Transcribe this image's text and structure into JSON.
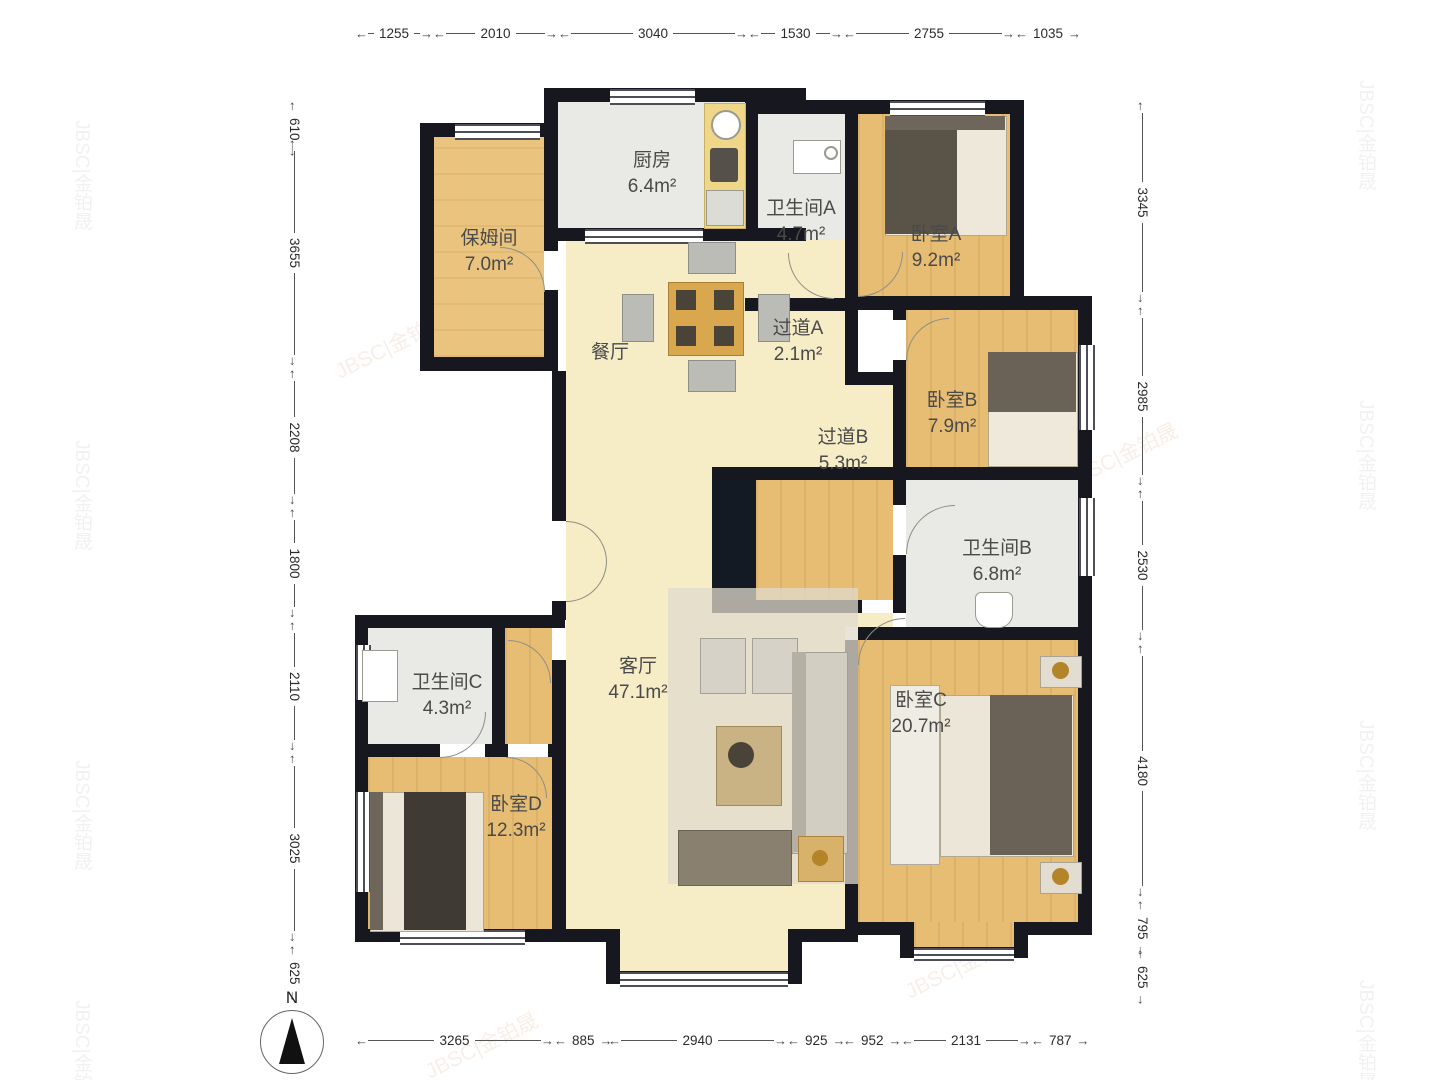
{
  "compass": {
    "label": "N"
  },
  "watermark": {
    "text": "JBSC|金铂晟"
  },
  "rooms": {
    "kitchen": {
      "name": "厨房",
      "area": "6.4m²"
    },
    "nanny": {
      "name": "保姆间",
      "area": "7.0m²"
    },
    "bathA": {
      "name": "卫生间A",
      "area": "4.7m²"
    },
    "bedA": {
      "name": "卧室A",
      "area": "9.2m²"
    },
    "hallA": {
      "name": "过道A",
      "area": "2.1m²"
    },
    "dining": {
      "name": "餐厅",
      "area": ""
    },
    "bedB": {
      "name": "卧室B",
      "area": "7.9m²"
    },
    "hallB": {
      "name": "过道B",
      "area": "5.3m²"
    },
    "bathB": {
      "name": "卫生间B",
      "area": "6.8m²"
    },
    "bathC": {
      "name": "卫生间C",
      "area": "4.3m²"
    },
    "living": {
      "name": "客厅",
      "area": "47.1m²"
    },
    "bedC": {
      "name": "卧室C",
      "area": "20.7m²"
    },
    "bedD": {
      "name": "卧室D",
      "area": "12.3m²"
    }
  },
  "dimensions": {
    "top": [
      "1255",
      "2010",
      "3040",
      "1530",
      "2755",
      "1035"
    ],
    "left": [
      "610",
      "3655",
      "2208",
      "1800",
      "2110",
      "3025",
      "625"
    ],
    "right": [
      "3345",
      "2985",
      "2530",
      "4180",
      "795",
      "625"
    ],
    "bottom": [
      "3265",
      "885",
      "2940",
      "925",
      "952",
      "2131",
      "787"
    ]
  }
}
